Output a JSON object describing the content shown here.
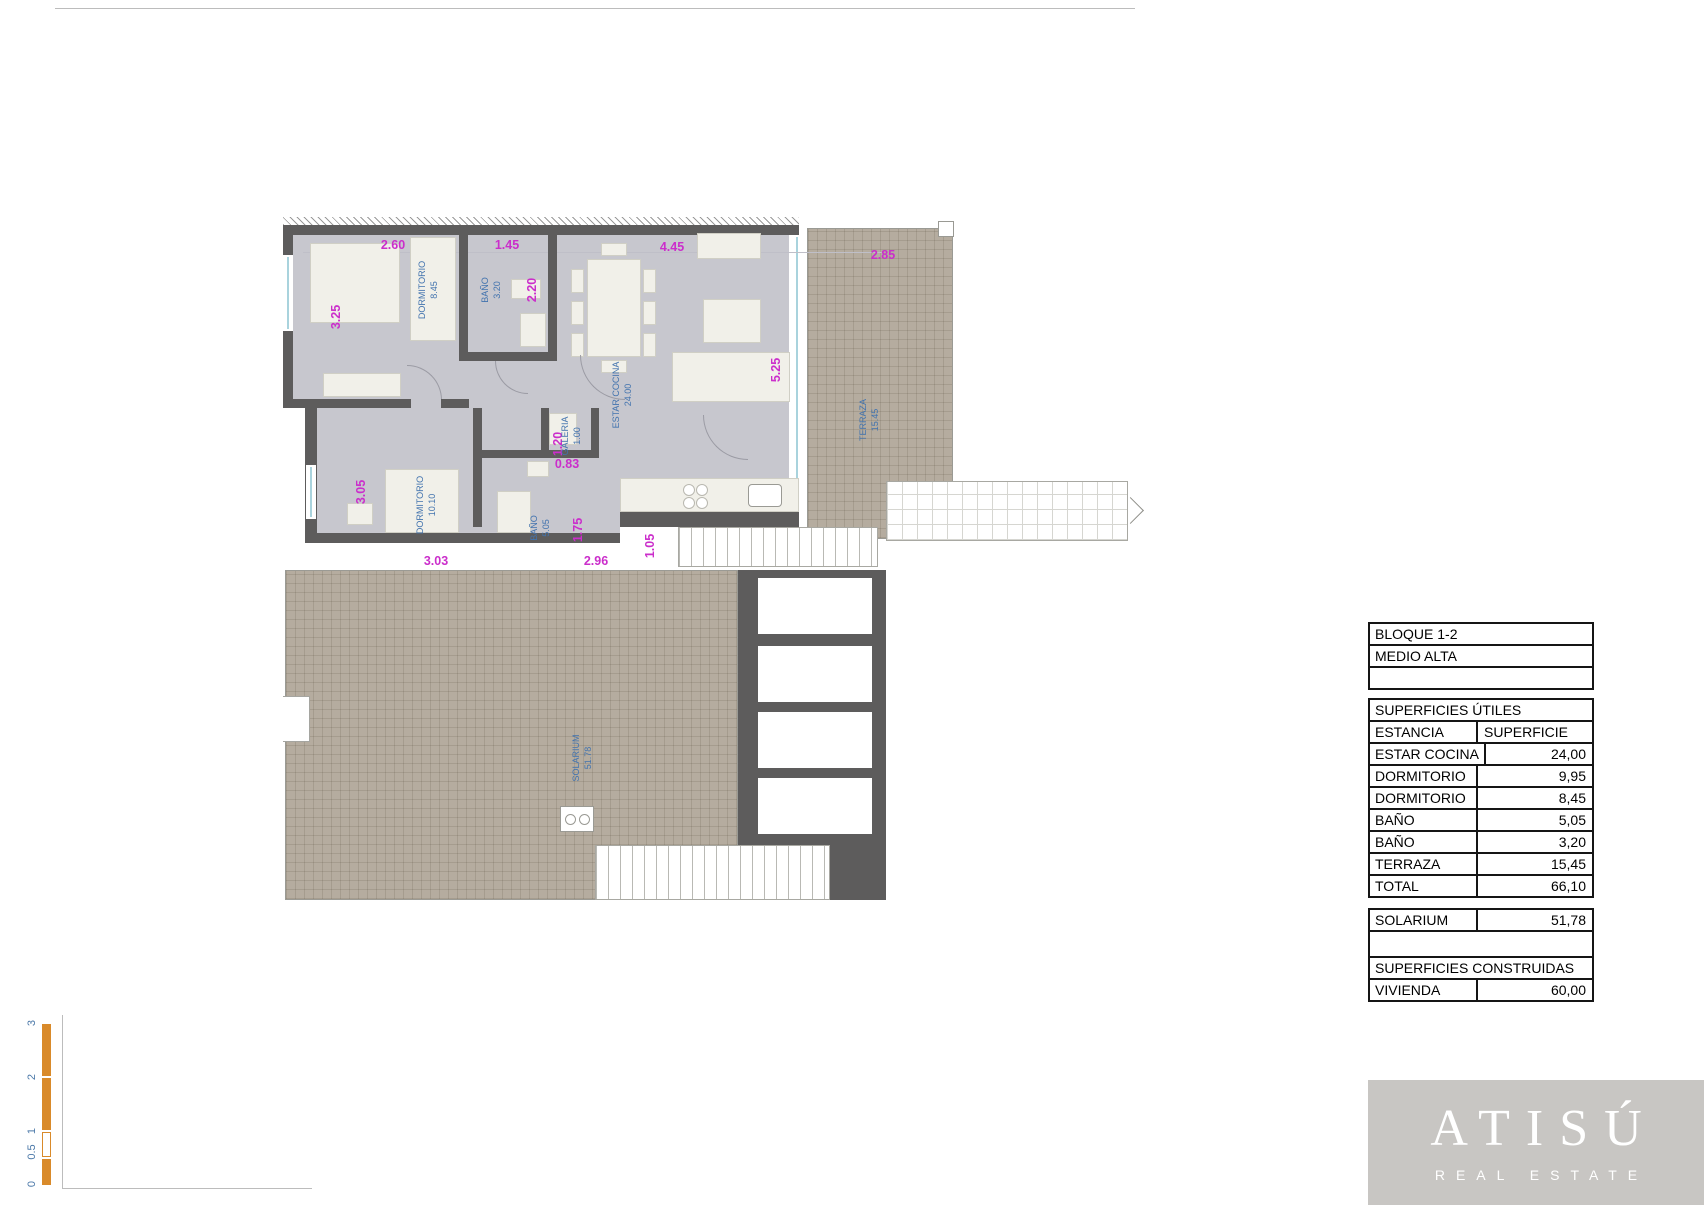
{
  "colors": {
    "wall": "#5d5c5c",
    "floor": "#c7c7ce",
    "terrace": "#b5ac9f",
    "dimension_text": "#cb2ecb",
    "room_text": "#4273ae",
    "scalebar": "#d98a2a",
    "logo_bg": "#c8c6c3"
  },
  "plan_upper": {
    "dims": {
      "dorm1_width": "2.60",
      "bath1_width": "1.45",
      "living_width": "4.45",
      "terrace_width": "2.85",
      "dorm1_height": "3.25",
      "bath1_height": "2.20",
      "living_height": "5.25",
      "dorm2_height": "3.05",
      "dorm2_width": "3.03",
      "bath2_width": "2.96",
      "bath2_height": "1.75",
      "galeria_height": "1.20",
      "galeria_width": "0.83",
      "hall_width": "1.05"
    },
    "rooms": {
      "dorm1": {
        "name": "DORMITORIO",
        "area": "8.45"
      },
      "bath1": {
        "name": "BAÑO",
        "area": "3.20"
      },
      "living": {
        "name": "ESTAR COCINA",
        "area": "24.00"
      },
      "dorm2": {
        "name": "DORMITORIO",
        "area": "10.10"
      },
      "bath2": {
        "name": "BAÑO",
        "area": "5.05"
      },
      "galeria": {
        "name": "GALERIA",
        "area": "1.00"
      },
      "terrace": {
        "name": "TERRAZA",
        "area": "15.45"
      }
    }
  },
  "plan_lower": {
    "solarium": {
      "name": "SOLARIUM",
      "area": "51.78"
    }
  },
  "table": {
    "rows": [
      {
        "label": "BLOQUE 1-2"
      },
      {
        "label": "MEDIO ALTA"
      },
      {
        "label": ""
      },
      {
        "spacer": true
      },
      {
        "label": "SUPERFICIES ÚTILES"
      },
      {
        "label": "ESTANCIA",
        "value": "SUPERFICIE"
      },
      {
        "label": "ESTAR COCINA",
        "value": "24,00"
      },
      {
        "label": "DORMITORIO",
        "value": "9,95"
      },
      {
        "label": "DORMITORIO",
        "value": "8,45"
      },
      {
        "label": "BAÑO",
        "value": "5,05"
      },
      {
        "label": "BAÑO",
        "value": "3,20"
      },
      {
        "label": "TERRAZA",
        "value": "15,45"
      },
      {
        "label": "TOTAL",
        "value": "66,10"
      },
      {
        "spacer": true
      },
      {
        "label": "SOLARIUM",
        "value": "51,78"
      },
      {
        "label": ""
      },
      {
        "label": "SUPERFICIES CONSTRUIDAS"
      },
      {
        "label": "VIVIENDA",
        "value": "60,00"
      }
    ]
  },
  "scalebar": {
    "labels": [
      "3",
      "2",
      "1",
      "0.5",
      "0"
    ]
  },
  "logo": {
    "brand": "ATISÚ",
    "tagline": "REAL ESTATE"
  }
}
